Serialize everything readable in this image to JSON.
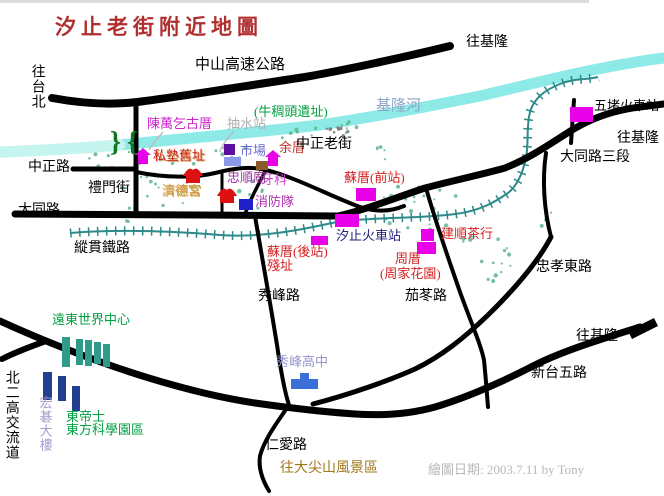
{
  "title": "汐止老街附近地圖",
  "credit": "繪圖日期: 2003.7.11 by Tony",
  "water": {
    "keelung_river": "基隆河"
  },
  "roads": {
    "freeway": "中山高速公路",
    "to_taipei": "往台北",
    "to_keelung_top": "往基隆",
    "to_keelung_right": "往基隆",
    "to_keelung_bottom": "往基隆",
    "zhongzheng_rd": "中正路",
    "zhongzheng_old": "中正老街",
    "limen_st": "禮門街",
    "datong_rd": "大同路",
    "datong_sec3": "大同路三段",
    "zongguan_rw": "縱貫鐵路",
    "xiufeng_rd": "秀峰路",
    "qiedong_rd": "茄苳路",
    "zhongxiao": "忠孝東路",
    "xintai5": "新台五路",
    "renai_rd": "仁愛路",
    "n2_interchange": "北二高交流道",
    "to_dajianshan": "往大尖山風景區"
  },
  "places": {
    "chen_wanqi": "陳萬乞古厝",
    "pump_station": "抽水站",
    "niuchoutou": "(牛稠頭遺址)",
    "sishu": "私塾舊址",
    "market": "市場",
    "yu_house": "余厝",
    "zhongshun": "忠順廟",
    "dentist": "牙科",
    "jide": "濟德宮",
    "fire_dept": "消防隊",
    "su_front": "蘇厝(前站)",
    "su_back": "蘇厝(後站)",
    "su_back_line2": "殘址",
    "xizhi_station": "汐止火車站",
    "wudu_station": "五堵火車站",
    "jianshun": "建順茶行",
    "zhou_house": "周厝",
    "zhou_garden": "(周家花園)",
    "yuandong": "遠東世界中心",
    "acer": "宏碁大樓",
    "dongdishi": "東帝士",
    "dongfang": "東方科學園區",
    "xiufeng_hs": "秀峰高中"
  },
  "colors": {
    "title_red": "#B03030",
    "road_black": "#000000",
    "river_cyan": "#8DEAE6",
    "river_label_blue": "#8CA6C8",
    "railway_teal": "#2D8A8A",
    "marker_magenta": "#E800E8",
    "temple_red": "#DD1111",
    "market_purple": "#5A0F9E",
    "market_lightblue": "#8A9AE8",
    "fire_blue": "#2020C8",
    "school_blue": "#3A6FD8",
    "building_teal": "#2E9B8B",
    "building_navy": "#223F8F",
    "brown_square": "#8B5A2B",
    "green_label": "#00A040",
    "red_label": "#D42020",
    "magenta_label": "#CC22CC",
    "purple_label": "#A030A0",
    "orange_label": "#D89040",
    "brown_label": "#A07818",
    "gray_label": "#AFAFAF",
    "navy_label": "#202080",
    "credit_gray": "#B8B8B8",
    "bridge_green": "#117722",
    "tree_green": "#58B088"
  }
}
